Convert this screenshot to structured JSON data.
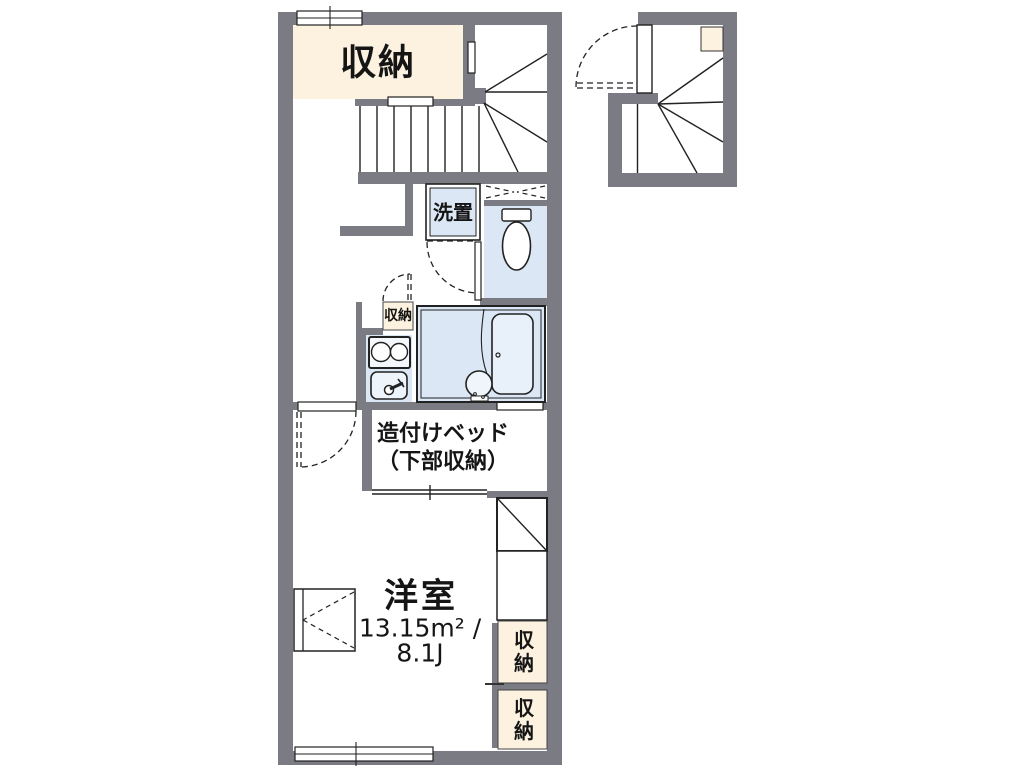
{
  "plan": {
    "title": "apartment-floor-plan",
    "colors": {
      "wall_gray": "#7b7b84",
      "storage_cream": "#fcf2df",
      "water_blue": "#dbe7f4",
      "line_black": "#222222",
      "background": "#ffffff"
    },
    "labels": {
      "closet_top": "収納",
      "washer_space": "洗置",
      "closet_small": "収納",
      "bed_line1": "造付けベッド",
      "bed_line2": "（下部収納）",
      "room_name": "洋室",
      "room_area": "13.15m² /",
      "room_tatami": "8.1J",
      "storage_right_upper": "収納",
      "storage_right_lower": "収納"
    }
  }
}
